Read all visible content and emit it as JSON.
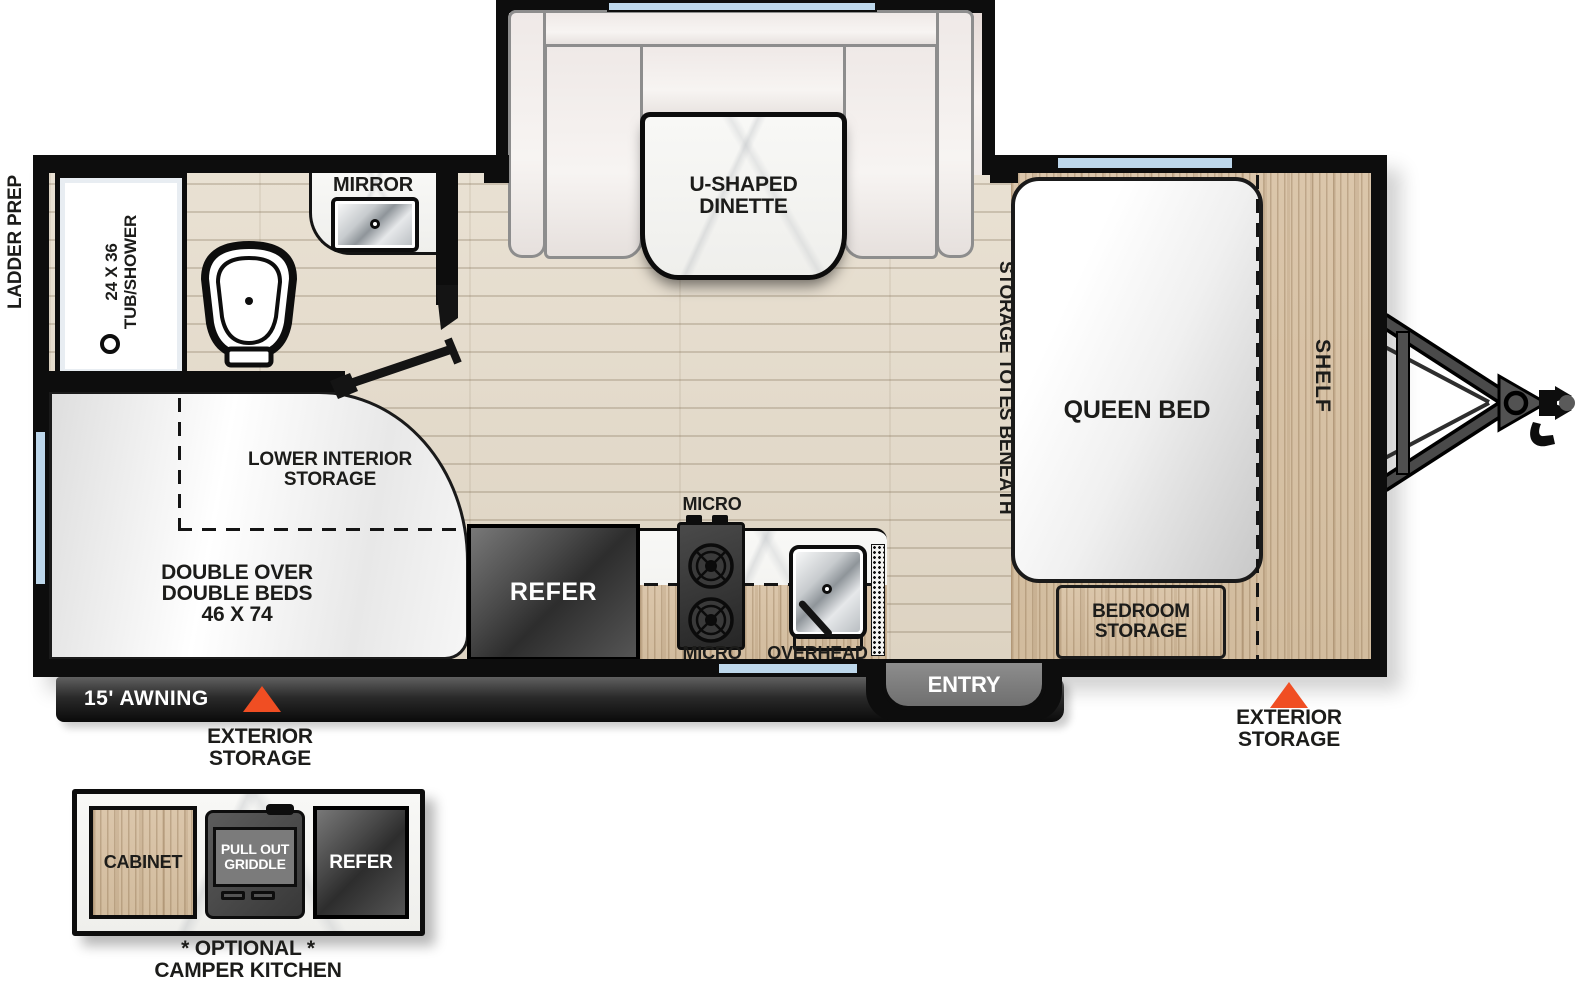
{
  "colors": {
    "accent_orange": "#F04E23",
    "window_blue": "#BDD7EB",
    "wall_black": "#0D0D0D"
  },
  "exterior_labels": {
    "ladder_prep": "LADDER PREP",
    "awning": "15' AWNING",
    "entry": "ENTRY",
    "storage_left_line1": "EXTERIOR",
    "storage_left_line2": "STORAGE",
    "storage_right_line1": "EXTERIOR",
    "storage_right_line2": "STORAGE"
  },
  "bathroom": {
    "tub_line1": "24 X 36",
    "tub_line2": "TUB/SHOWER",
    "mirror": "MIRROR"
  },
  "dinette": {
    "line1": "U-SHAPED",
    "line2": "DINETTE"
  },
  "bedroom": {
    "queen": "QUEEN BED",
    "shelf": "SHELF",
    "storage_totes": "STORAGE TOTES BENEATH",
    "bedroom_storage_line1": "BEDROOM",
    "bedroom_storage_line2": "STORAGE"
  },
  "bunks": {
    "line1": "DOUBLE OVER",
    "line2": "DOUBLE BEDS",
    "line3": "46 X 74",
    "lower_line1": "LOWER INTERIOR",
    "lower_line2": "STORAGE"
  },
  "kitchen": {
    "refer": "REFER",
    "micro_top": "MICRO",
    "micro_bottom": "MICRO",
    "overhead": "OVERHEAD"
  },
  "camper_kitchen": {
    "cabinet": "CABINET",
    "griddle_line1": "PULL OUT",
    "griddle_line2": "GRIDDLE",
    "refer": "REFER",
    "caption_line1": "* OPTIONAL *",
    "caption_line2": "CAMPER KITCHEN"
  }
}
